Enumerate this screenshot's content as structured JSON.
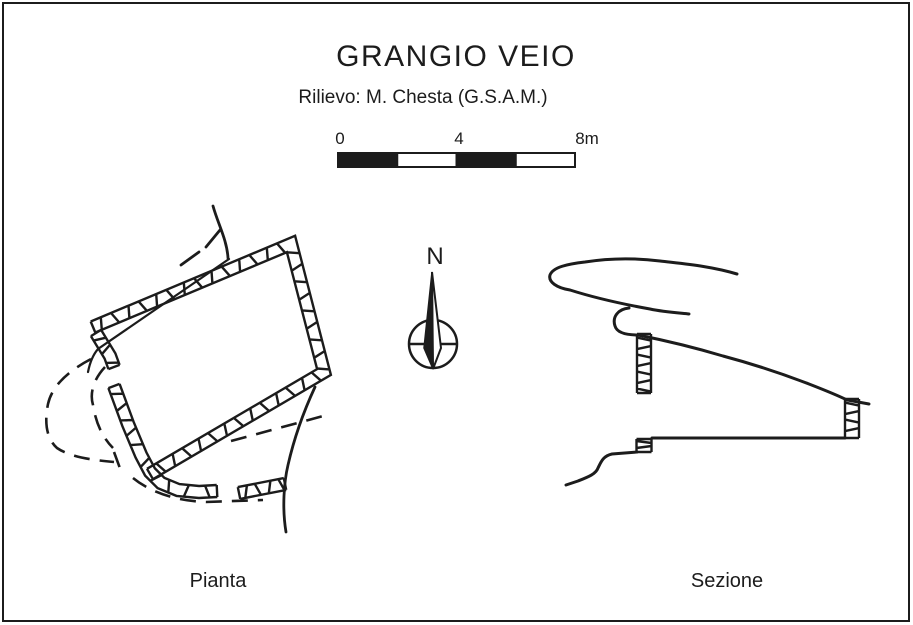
{
  "colors": {
    "ink": "#1c1c1c",
    "paper": "#ffffff"
  },
  "header": {
    "title": "GRANGIO VEIO",
    "subtitle": "Rilievo: M. Chesta (G.S.A.M.)"
  },
  "scale_bar": {
    "tick_labels": [
      "0",
      "4",
      "8m"
    ],
    "total_meters": 8,
    "segments": 4
  },
  "compass": {
    "north_label": "N"
  },
  "views": {
    "plan_label": "Pianta",
    "section_label": "Sezione"
  }
}
